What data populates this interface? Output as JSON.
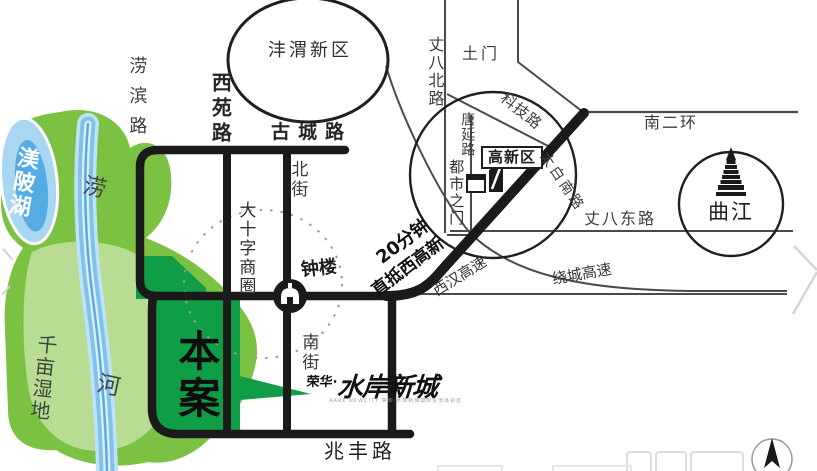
{
  "map": {
    "districts": {
      "fengwei_new_district": "沣渭新区",
      "gaoxin_district": "高新区",
      "qujiang": "曲江",
      "tumen": "土门",
      "dashizi_business_circle": "大十字商圈"
    },
    "roads": {
      "laobin_road": "涝滨路",
      "xiyuan_road": "西苑路",
      "gucheng_road": "古城路",
      "north_street": "北街",
      "south_street": "南街",
      "zhaofeng_road": "兆丰路",
      "zhangba_north_road": "丈八北路",
      "zhangba_east_road": "丈八东路",
      "keji_road": "科技路",
      "tangyan_road": "唐延路",
      "taibai_south_road": "太白南路",
      "south_2nd_ring": "南二环"
    },
    "expressways": {
      "xihan_expressway": "西汉高速",
      "raocheng_expressway": "绕城高速"
    },
    "waters": {
      "meipi_lake": "渼陂湖",
      "river_char_top": "涝",
      "river_char_bottom": "河",
      "wetland": "千亩湿地"
    },
    "landmarks": {
      "bell_tower": "钟楼",
      "city_gate": "都市之门"
    },
    "project": {
      "site_label": "本案",
      "brand_prefix": "荣华·",
      "brand_name": "水岸新城",
      "brand_tagline": "RARE NEWCITY 荣华·水岸新城国际生活体验区"
    },
    "slogan": {
      "line1": "20分钟",
      "line2": "直抵西高新"
    },
    "colors": {
      "site_green": "#0f9d45",
      "park_green": "#7cc242",
      "wetland_green": "#b8dc92",
      "lake_blue": "#55ace2",
      "river_blue": "#7cc0ea",
      "road_black": "#1a1a1a"
    }
  }
}
